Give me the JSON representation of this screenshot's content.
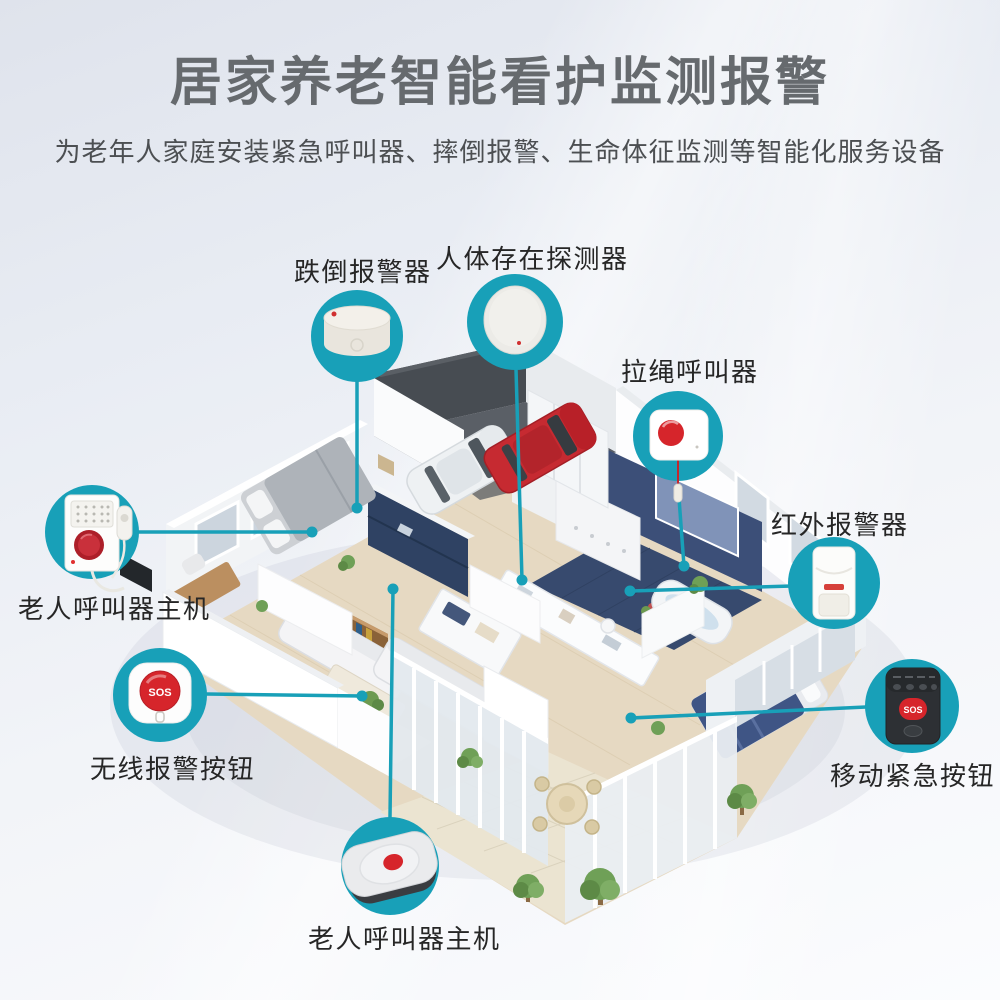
{
  "header": {
    "title": "居家养老智能看护监测报警",
    "subtitle": "为老年人家庭安装紧急呼叫器、摔倒报警、生命体征监测等智能化服务设备"
  },
  "callouts": [
    {
      "id": "fall-alarm",
      "label": "跌倒报警器"
    },
    {
      "id": "presence-detector",
      "label": "人体存在探测器"
    },
    {
      "id": "pull-cord-caller",
      "label": "拉绳呼叫器"
    },
    {
      "id": "infrared-alarm",
      "label": "红外报警器"
    },
    {
      "id": "mobile-sos-button",
      "label": "移动紧急按钮"
    },
    {
      "id": "elder-caller-host-left",
      "label": "老人呼叫器主机"
    },
    {
      "id": "wireless-sos-button",
      "label": "无线报警按钮"
    },
    {
      "id": "elder-caller-host-bottom",
      "label": "老人呼叫器主机"
    }
  ],
  "device_text": {
    "sos": "SOS"
  },
  "colors": {
    "accent_teal": "#18a0b8",
    "alert_red": "#d6252b",
    "title_gray": "#666a6e"
  }
}
